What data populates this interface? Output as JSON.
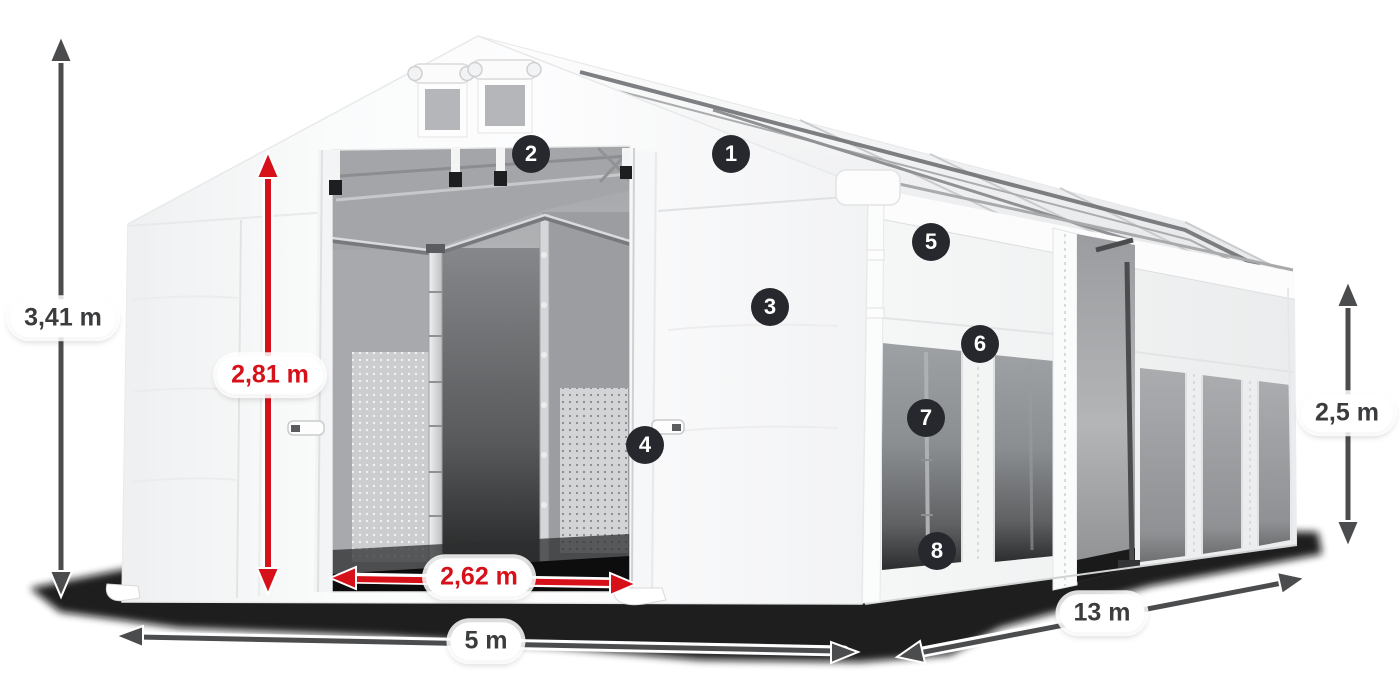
{
  "scene": {
    "description": "White PVC storage tent 5 x 13 m with gable roof, open front double doors, side windows, dimension arrows and numbered feature callouts",
    "background_color": "#ffffff"
  },
  "colors": {
    "dimension_red": "#d6111a",
    "dimension_dark": "#4b4c4e",
    "badge_background": "#26282d",
    "badge_text": "#ffffff",
    "label_background": "#ffffff",
    "label_text": "#3b3c3e",
    "tent_white": "#f8f8f9",
    "window_gray": "#8f9194",
    "ground_shadow": "#0c0d0d"
  },
  "dimensions": {
    "total_height": {
      "label": "3,41 m",
      "color_role": "dark"
    },
    "door_height": {
      "label": "2,81 m",
      "color_role": "red"
    },
    "door_width": {
      "label": "2,62 m",
      "color_role": "red"
    },
    "front_width": {
      "label": "5 m",
      "color_role": "dark"
    },
    "side_height": {
      "label": "2,5 m",
      "color_role": "dark"
    },
    "length": {
      "label": "13 m",
      "color_role": "dark"
    }
  },
  "callouts": {
    "items": [
      "1",
      "2",
      "3",
      "4",
      "5",
      "6",
      "7",
      "8"
    ]
  }
}
